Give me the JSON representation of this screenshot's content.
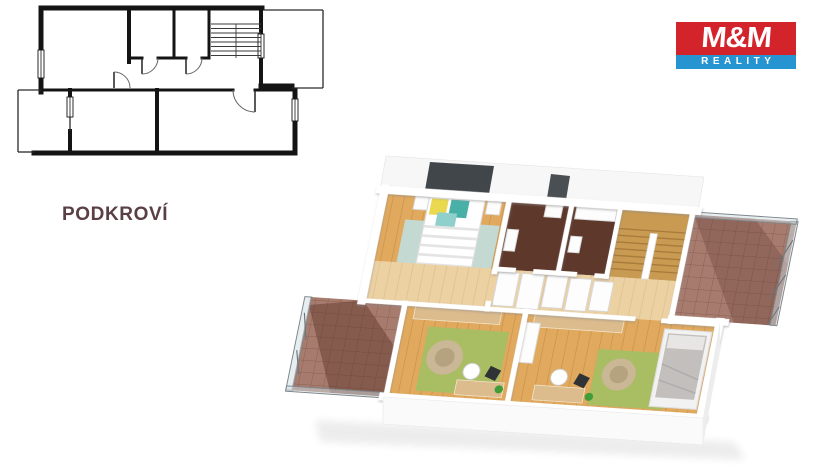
{
  "floor_label": "PODKROVÍ",
  "logo": {
    "line1": "M&M",
    "line2": "REALITY"
  },
  "palette": {
    "logo_red": "#d3242b",
    "logo_blue": "#2694d1",
    "label_text": "#5a4044",
    "wood_floor": "#e1a95e",
    "hall_wood": "#ecd1a3",
    "stair_wood": "#c89a52",
    "dark_floor": "#5e382b",
    "tile": "#a77c6f",
    "rug_teal": "#c5d9d3",
    "rug_green": "#a9bd62",
    "beanbag": "#c9b795",
    "plan_line": "#141414",
    "wall_white": "#ffffff"
  }
}
